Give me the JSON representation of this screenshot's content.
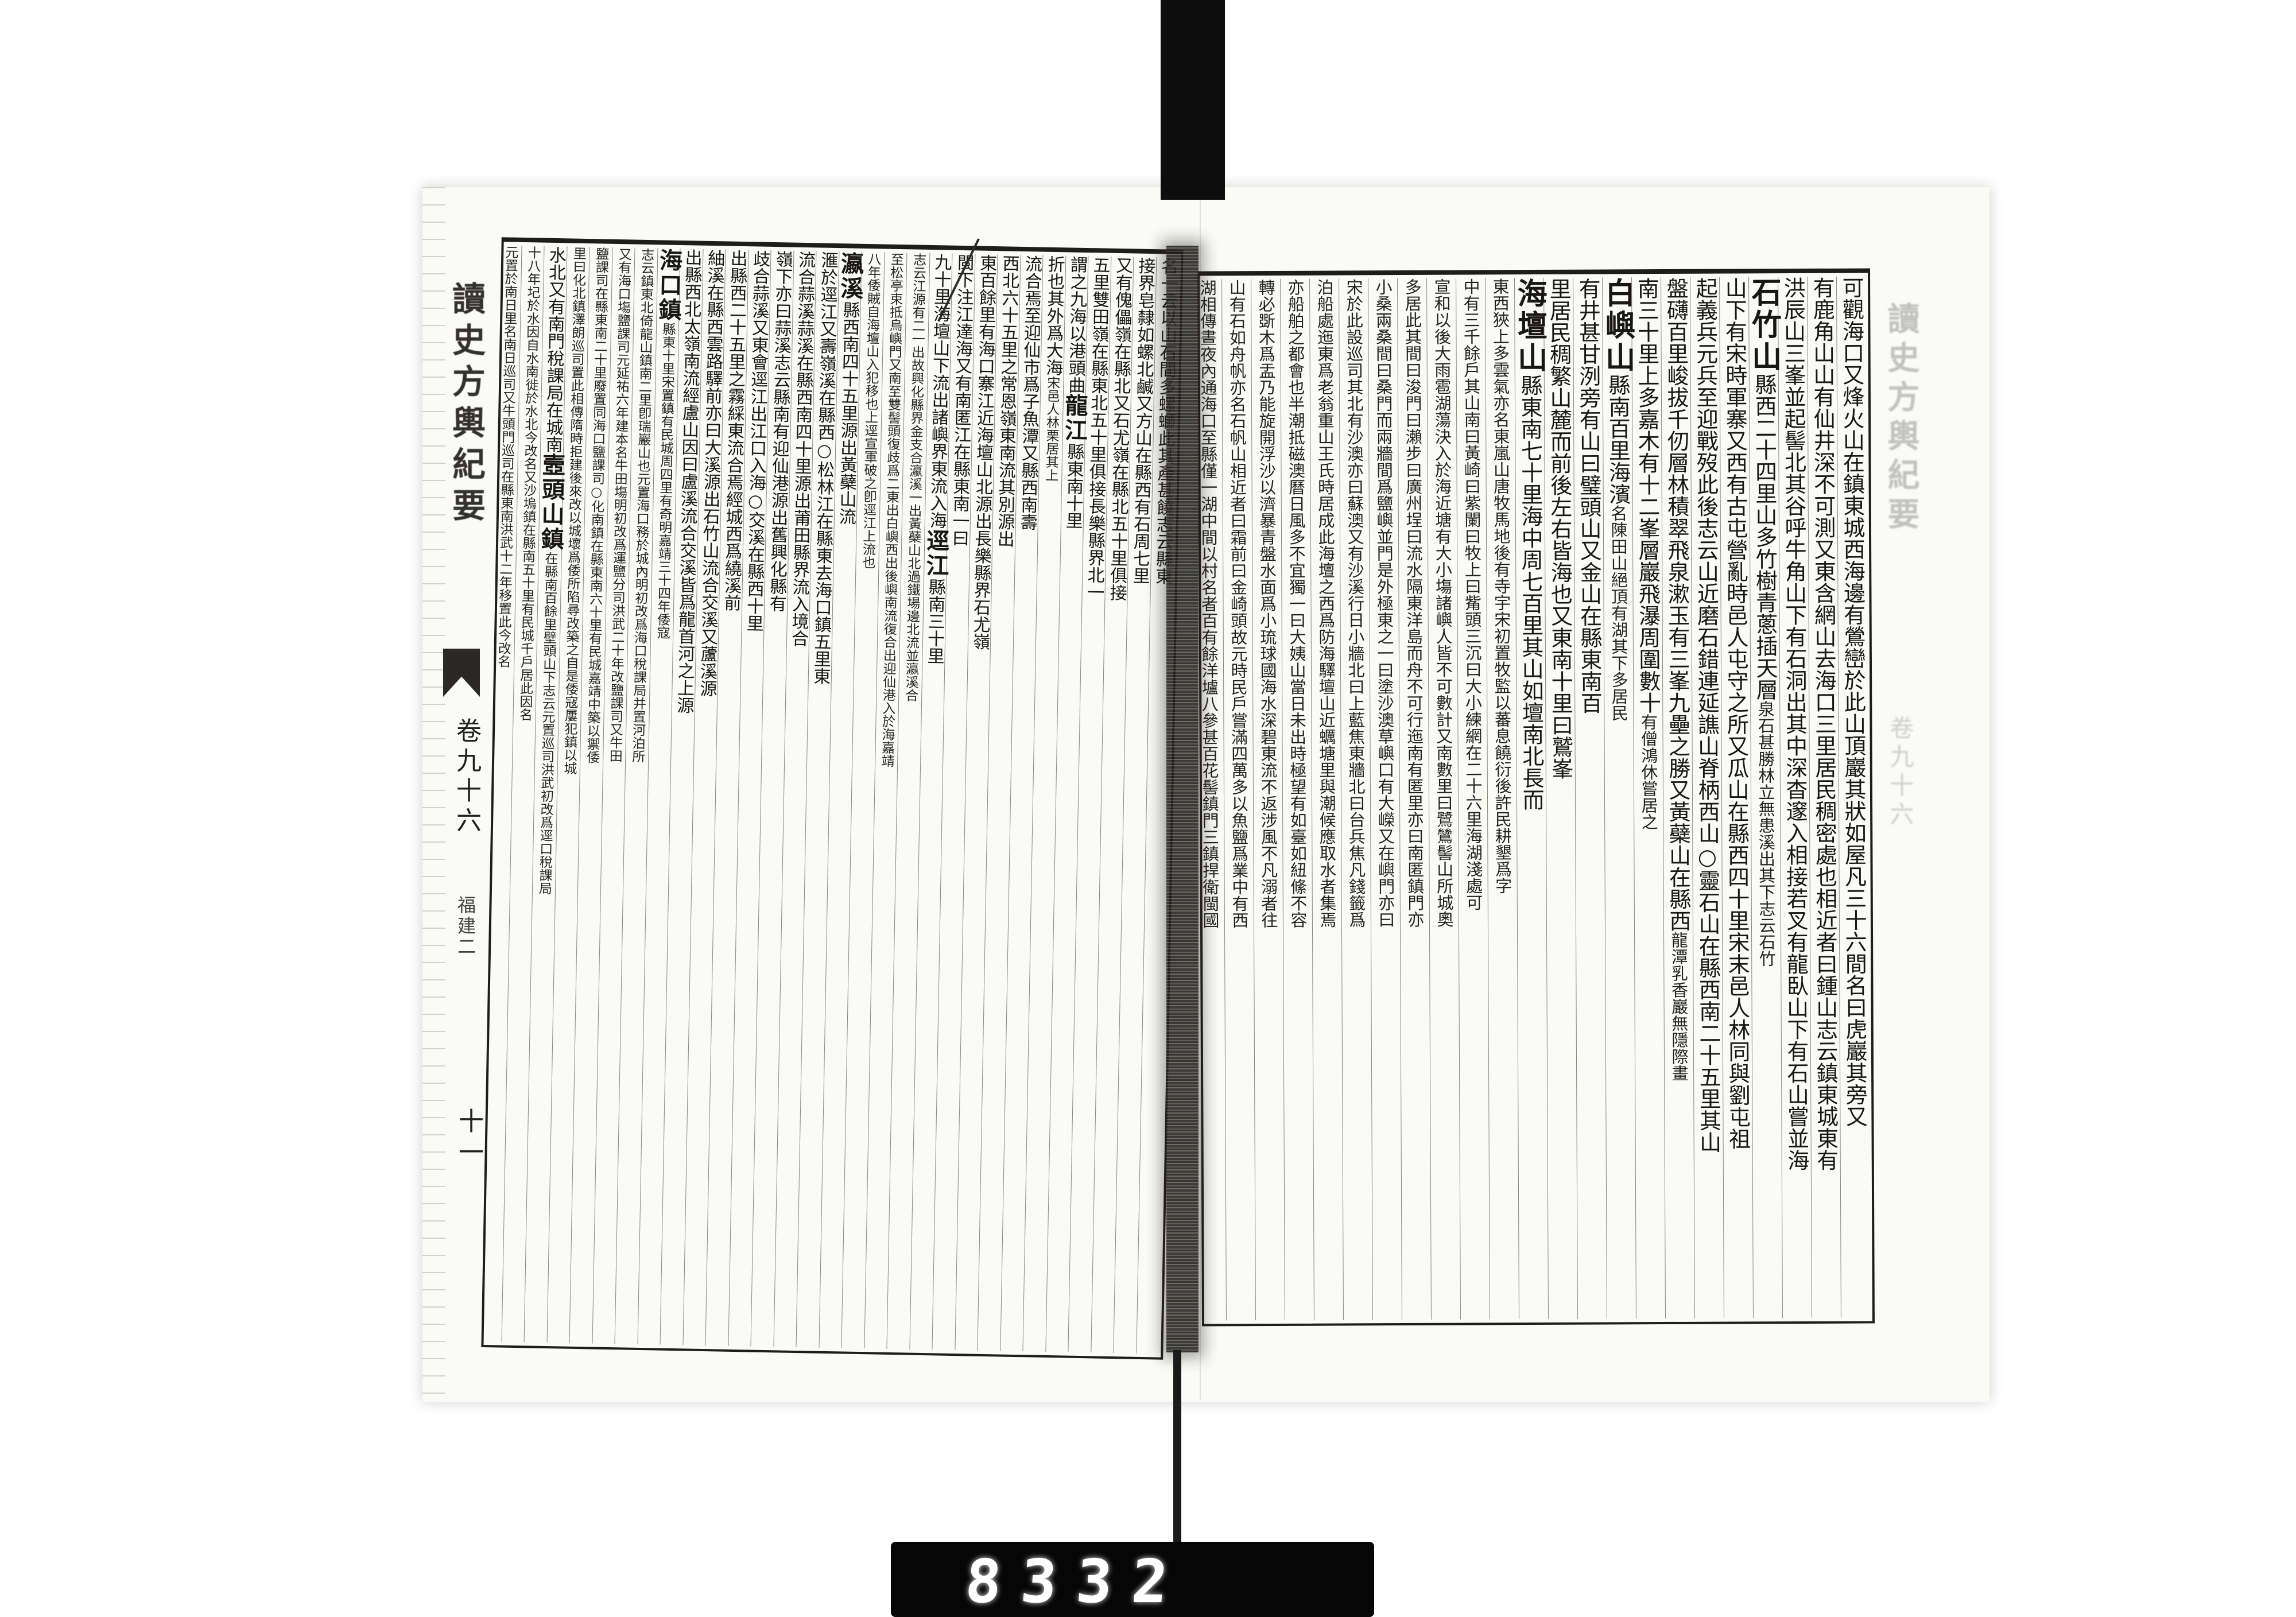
{
  "document": {
    "title": "讀史方輿紀要",
    "volume": "卷九十六",
    "section": "福建二",
    "folio": "十一",
    "counter": "8332"
  },
  "right_page": {
    "margin_title": "讀史方輿紀要",
    "margin_volume": "卷九十六",
    "columns": [
      {
        "segs": [
          [
            "n",
            "可觀海口又烽火山在鎮東城西海邊有鶯巒於此山頂巖其狀如屋凡三十六間名曰虎巖其旁又"
          ]
        ]
      },
      {
        "segs": [
          [
            "n",
            "有鹿角山山有仙井深不可測又東含網山去海口三里居民稠密處也相近者曰鍾山志云鎮東城東有"
          ]
        ]
      },
      {
        "segs": [
          [
            "n",
            "洪辰山三峯並起髻北其谷呼牛角山下有石洞出其中深杳邃入相接若叉有龍臥山下有石山嘗並海"
          ]
        ]
      },
      {
        "segs": [
          [
            "h",
            "石竹山"
          ],
          [
            "n",
            "縣西二十四里山多竹樹青蔥插天層"
          ],
          [
            "s",
            "泉石甚勝林立無患溪出其下志云石竹"
          ]
        ]
      },
      {
        "segs": [
          [
            "n",
            "山下有宋時軍寨又西有古屯營亂時邑人屯守之所又瓜山在縣西四十里宋末邑人林同與劉屯祖"
          ]
        ]
      },
      {
        "segs": [
          [
            "n",
            "起義兵元兵至迎戰歿此後志云山近磨石錯連延譙山脊柄西山○靈石山在縣西南二十五里其山"
          ]
        ]
      },
      {
        "segs": [
          [
            "n",
            "盤礴百里峻拔千仞層林積翠飛泉漱玉有三峯九壘之勝又黃蘗山在縣西"
          ],
          [
            "s",
            "龍潭乳香巖無隱際畫"
          ]
        ]
      },
      {
        "segs": [
          [
            "n",
            "南三十里上多嘉木有十二峯層巖飛瀑周圍數十"
          ],
          [
            "s",
            "有僧鴻休嘗居之"
          ]
        ]
      },
      {
        "segs": [
          [
            "h",
            "白嶼山"
          ],
          [
            "n",
            "縣南百里海濱"
          ],
          [
            "s",
            "名陳田山絕頂有湖其下多居民"
          ]
        ]
      },
      {
        "segs": [
          [
            "n",
            "有井甚甘洌旁有山曰璧頭山又金山在縣東南百"
          ]
        ]
      },
      {
        "segs": [
          [
            "n",
            "里居民稠繁山麓而前後左右皆海也又東南十里曰鷲峯"
          ]
        ]
      },
      {
        "segs": [
          [
            "h",
            "海壇山"
          ],
          [
            "n",
            "縣東南七十里海中周七百里其山如壇南北長而"
          ]
        ]
      },
      {
        "segs": [
          [
            "s",
            "東西狹上多雲氣亦名東嵐山唐牧馬地後有寺宇宋初置牧監以蕃息饒衍後許民耕墾爲字"
          ]
        ]
      },
      {
        "segs": [
          [
            "s",
            "中有三千餘戶其山南曰黃崎曰紫闌曰牧上曰觜頭三沉曰大小練網在二十六里海湖淺處可"
          ]
        ]
      },
      {
        "segs": [
          [
            "s",
            "宣和以後大雨雹湖蕩決入於海近塘有大小塲諸嶼人皆不可數計又南數里曰鷺鷥髻山所城奧"
          ]
        ]
      },
      {
        "segs": [
          [
            "s",
            "多居此其間曰浚門曰瀨步曰廣州埕曰流水隔東洋島而舟不可行迤南有匿里亦曰南匿鎮門亦"
          ]
        ]
      },
      {
        "segs": [
          [
            "s",
            "小桑兩桑間曰桑門而兩牆間爲鹽嶼並門是外極東之一曰塗沙澳草嶼口有大嶸又在嶼門亦曰"
          ]
        ]
      },
      {
        "segs": [
          [
            "s",
            "宋於此設巡司其北有沙澳亦曰蘇澳又有沙溪行日小牆北曰上藍焦東牆北曰台兵焦凡錢籤爲"
          ]
        ]
      },
      {
        "segs": [
          [
            "s",
            "泊船處迤東爲老翁重山王氏時居成此海壇之西爲防海驛壇山近蠣塘里與潮候應取水者集焉"
          ]
        ]
      },
      {
        "segs": [
          [
            "s",
            "亦船舶之都會也半潮抵磁澳曆日風多不宜獨一曰大姨山當日未出時極望有如臺如紐絛不容"
          ]
        ]
      },
      {
        "segs": [
          [
            "s",
            "轉必斲木爲盂乃能旋開浮沙以濟暴青盤水面爲小琉球國海水深碧東流不返涉風不凡溺者往"
          ]
        ]
      },
      {
        "segs": [
          [
            "s",
            "山有石如舟帆亦名石帆山相近者曰霜前曰金崎頭故元時民戶嘗滿四萬多以魚鹽爲業中有西"
          ]
        ]
      },
      {
        "segs": [
          [
            "s",
            "湖相傳晝夜內通海口至縣僅一湖中間以村名者百有餘洋壚八參甚百花髻鎮門三鎮捍衛閩國"
          ]
        ]
      }
    ]
  },
  "left_page": {
    "margin_title": "讀史方輿紀要",
    "margin_volume": "卷九十六",
    "margin_section": "福建二",
    "folio": "十一",
    "columns": [
      {
        "segs": [
          [
            "n",
            "名一云以山石間多螺螄此其產甚饒志云縣東"
          ]
        ]
      },
      {
        "segs": [
          [
            "n",
            "接界皂隸如螺北鹹又方山在縣西有石周七里"
          ]
        ]
      },
      {
        "segs": [
          [
            "n",
            "又有傀儡嶺在縣北又石尤嶺在縣北五十里俱接"
          ]
        ]
      },
      {
        "segs": [
          [
            "n",
            "五里雙田嶺在縣東北五十里俱接長樂縣界北一"
          ]
        ]
      },
      {
        "segs": [
          [
            "n",
            "謂之九海以港頭曲"
          ],
          [
            "h",
            "龍江"
          ],
          [
            "n",
            "縣東南十里"
          ]
        ]
      },
      {
        "segs": [
          [
            "n",
            "折也其外爲大海"
          ],
          [
            "s",
            "宋邑人林栗居其上"
          ]
        ]
      },
      {
        "segs": [
          [
            "n",
            "流合焉至迎仙市爲子魚潭又縣西南壽"
          ]
        ]
      },
      {
        "segs": [
          [
            "n",
            "西北六十五里之常恩嶺東南流其別源出"
          ]
        ]
      },
      {
        "segs": [
          [
            "n",
            "東百餘里有海口寨江近海壇山北源出長樂縣界石尤嶺"
          ]
        ]
      },
      {
        "segs": [
          [
            "n",
            "閩下注江達海又有南匿江在縣東南一曰"
          ]
        ]
      },
      {
        "segs": [
          [
            "n",
            "九十里海壇山下流出諸嶼界東流入海"
          ],
          [
            "h",
            "逕江"
          ],
          [
            "n",
            "縣南三十里"
          ]
        ]
      },
      {
        "segs": [
          [
            "s",
            "志云江源有二一出故興化縣界金支合瀛溪一出黃蘗山北過鐵場邊北流並瀛溪合"
          ]
        ]
      },
      {
        "segs": [
          [
            "s",
            "至松亭束抵烏嶼門又南至雙髻頭復歧爲二東出白嶼西出後嶼南流復合出迎仙港入於海嘉靖"
          ]
        ]
      },
      {
        "segs": [
          [
            "s",
            "八年倭賊自海壇山入犯移也上逕宣軍破之卽逕江上流也"
          ]
        ]
      },
      {
        "segs": [
          [
            "h",
            "瀛溪"
          ],
          [
            "n",
            "縣西南四十五里源出黃蘗山流"
          ]
        ]
      },
      {
        "segs": [
          [
            "n",
            "滙於逕江又壽嶺溪在縣西○松林江在縣東去海口鎮五里東"
          ]
        ]
      },
      {
        "segs": [
          [
            "n",
            "流合蒜溪蒜溪在縣西南四十里源出莆田縣界流入境合"
          ]
        ]
      },
      {
        "segs": [
          [
            "n",
            "嶺下亦曰蒜溪志云縣南有迎仙港源出舊興化縣有"
          ]
        ]
      },
      {
        "segs": [
          [
            "n",
            "歧合蒜溪又東會逕江出江口入海○交溪在縣西十里"
          ]
        ]
      },
      {
        "segs": [
          [
            "n",
            "出縣西二十五里之霧綵東流合焉經城西爲繞溪前"
          ]
        ]
      },
      {
        "segs": [
          [
            "n",
            "紬溪在縣西雲路驛前亦曰大溪源出石竹山流合交溪又蘆溪源"
          ]
        ]
      },
      {
        "segs": [
          [
            "n",
            "出縣西北太嶺南流經盧山因曰盧溪流合交溪皆爲龍首河之上源"
          ]
        ]
      },
      {
        "segs": [
          [
            "h",
            "海口鎮"
          ],
          [
            "s",
            "縣東十里宋置鎮有民城周四里有奇明嘉靖三十四年倭寇"
          ]
        ]
      },
      {
        "segs": [
          [
            "s",
            "志云鎮東北倚龍山鎮南二里卽瑞巖山也元置海口務於城內明初改爲海口稅課局并置河泊所"
          ]
        ]
      },
      {
        "segs": [
          [
            "s",
            "又有海口塲鹽課司元延祐六年建本名牛田塲明初改爲運鹽分司洪武二十年改鹽課司又牛田"
          ]
        ]
      },
      {
        "segs": [
          [
            "s",
            "鹽課司在縣東南二十里廢置同海口鹽課司○化南鎮在縣東南六十里有民城嘉靖中築以禦倭"
          ]
        ]
      },
      {
        "segs": [
          [
            "s",
            "里曰化北鎮澤朗巡司置此相傳隋時拒建後來改以城壞爲倭所陷尋改築之自是倭寇屢犯鎮以城"
          ]
        ]
      },
      {
        "segs": [
          [
            "n",
            "水北又有南門稅課局在城南"
          ],
          [
            "h",
            "壼頭山鎮"
          ],
          [
            "s",
            "在縣南百餘里壁頭山下志云元置巡司洪武初改爲逕口稅課局"
          ]
        ]
      },
      {
        "segs": [
          [
            "s",
            "十八年圮於水因自水南徙於水北今改名又沙塢鎮在縣南五十里有民城千戶居此因名"
          ]
        ]
      },
      {
        "segs": [
          [
            "s",
            "元置於南日里名南日巡司又牛頭門巡司在縣東南洪武十二年移置此今改名"
          ]
        ]
      }
    ]
  }
}
